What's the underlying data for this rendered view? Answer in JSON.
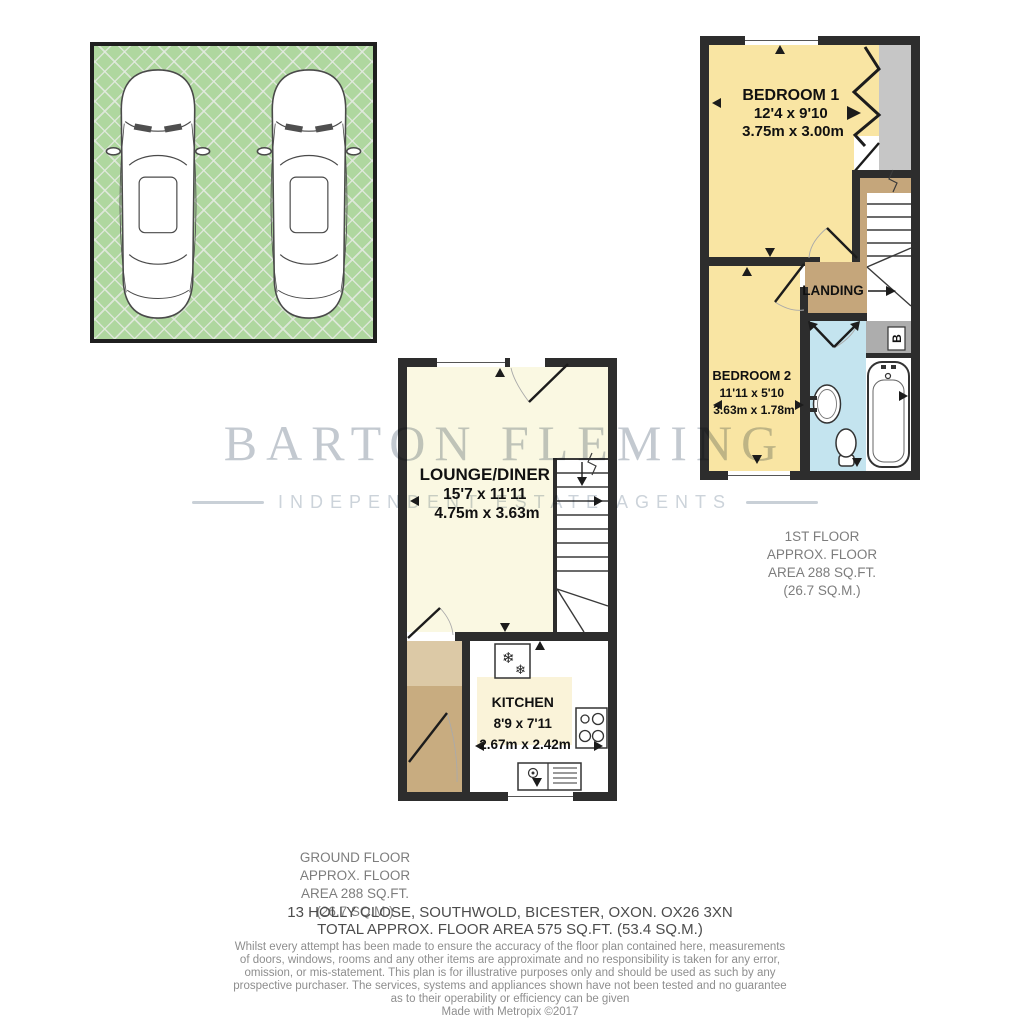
{
  "watermark": {
    "name": "BARTON FLEMING",
    "tagline": "INDEPENDENT ESTATE AGENTS"
  },
  "first_floor": {
    "bedroom1": {
      "name": "BEDROOM 1",
      "imperial": "12'4 x 9'10",
      "metric": "3.75m x 3.00m"
    },
    "bedroom2": {
      "name": "BEDROOM 2",
      "imperial": "11'11 x 5'10",
      "metric": "3.63m x 1.78m"
    },
    "landing_label": "LANDING",
    "boiler_label": "B",
    "caption": [
      "1ST FLOOR",
      "APPROX. FLOOR",
      "AREA 288 SQ.FT.",
      "(26.7 SQ.M.)"
    ]
  },
  "ground_floor": {
    "lounge": {
      "name": "LOUNGE/DINER",
      "imperial": "15'7 x 11'11",
      "metric": "4.75m x 3.63m"
    },
    "kitchen": {
      "name": "KITCHEN",
      "imperial": "8'9 x 7'11",
      "metric": "2.67m x 2.42m"
    },
    "caption": [
      "GROUND FLOOR",
      "APPROX. FLOOR",
      "AREA 288 SQ.FT.",
      "(26.7 SQ.M.)"
    ]
  },
  "footer": {
    "address": "13 HOLLY CLOSE, SOUTHWOLD, BICESTER, OXON. OX26 3XN",
    "total_area": "TOTAL APPROX. FLOOR AREA 575 SQ.FT. (53.4 SQ.M.)",
    "disclaimer": [
      "Whilst every attempt has been made to ensure the accuracy of the floor plan contained here, measurements",
      "of doors, windows, rooms and any other items are approximate and no responsibility is taken for any error,",
      "omission, or mis-statement. This plan is for illustrative purposes only and should be used as such by any",
      "prospective purchaser. The services, systems and appliances shown have not been tested and no guarantee",
      "as to their operability or efficiency can be given",
      "Made with Metropix ©2017"
    ]
  },
  "icons": {
    "fridge_snowflake_large": "❄",
    "fridge_snowflake_small": "❄"
  },
  "colors": {
    "wall": "#2d2d2d",
    "bedroom_fill": "#F9E5A3",
    "lounge_fill": "#FAF8E2",
    "kitchen_box_fill": "#FAF3D9",
    "landing_fill": "#C5A67B",
    "hall_fill": "#C8AC80",
    "hall_fill_light": "#DCC9A6",
    "bathroom_fill": "#C4E4EF",
    "wardrobe_fill": "#C6C6C6",
    "boiler_fill": "#ADADAD",
    "parking_fill": "#AFD79F",
    "watermark": "#C3C9D0"
  }
}
